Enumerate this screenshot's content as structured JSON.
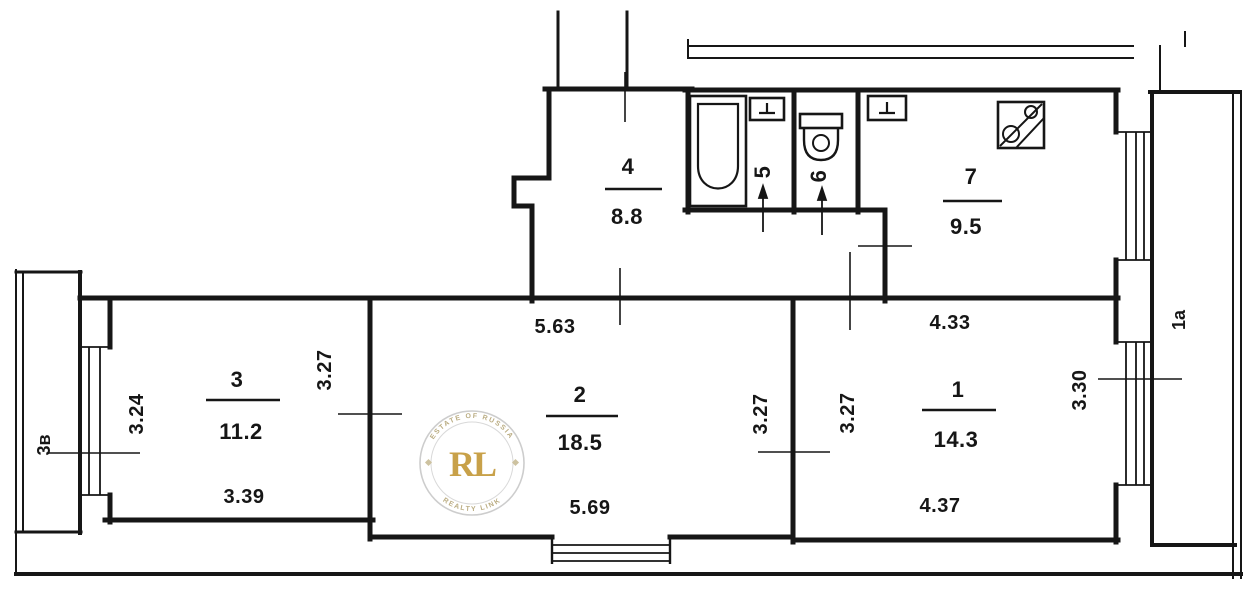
{
  "plan": {
    "ink_color": "#161616",
    "rooms": [
      {
        "id": "room-1",
        "number": "1",
        "area": "14.3"
      },
      {
        "id": "room-2",
        "number": "2",
        "area": "18.5"
      },
      {
        "id": "room-3",
        "number": "3",
        "area": "11.2"
      },
      {
        "id": "room-4-hall",
        "number": "4",
        "area": "8.8"
      },
      {
        "id": "room-5-bathroom",
        "number": "5"
      },
      {
        "id": "room-6-toilet",
        "number": "6"
      },
      {
        "id": "room-7-kitchen",
        "number": "7",
        "area": "9.5"
      }
    ],
    "balconies": [
      {
        "id": "balcony-left",
        "label": "3в"
      },
      {
        "id": "balcony-right",
        "label": "1а"
      }
    ],
    "dimensions": {
      "room2_top": "5.63",
      "room1_top": "4.33",
      "room3_left": "3.24",
      "room3_right": "3.27",
      "room2_right": "3.27",
      "room1_left": "3.27",
      "room1_right": "3.30",
      "room3_bottom": "3.39",
      "room2_bottom": "5.69",
      "room1_bottom": "4.37"
    },
    "fixtures": [
      "bathtub",
      "sink",
      "toilet",
      "kitchen-sink",
      "stove"
    ]
  },
  "watermark": {
    "letters": "RL",
    "top_text": "ESTATE OF RUSSIA",
    "bottom_text": "REALTY LINK",
    "gold_color": "#c49a3a",
    "ring_color": "#c9c9c9"
  }
}
